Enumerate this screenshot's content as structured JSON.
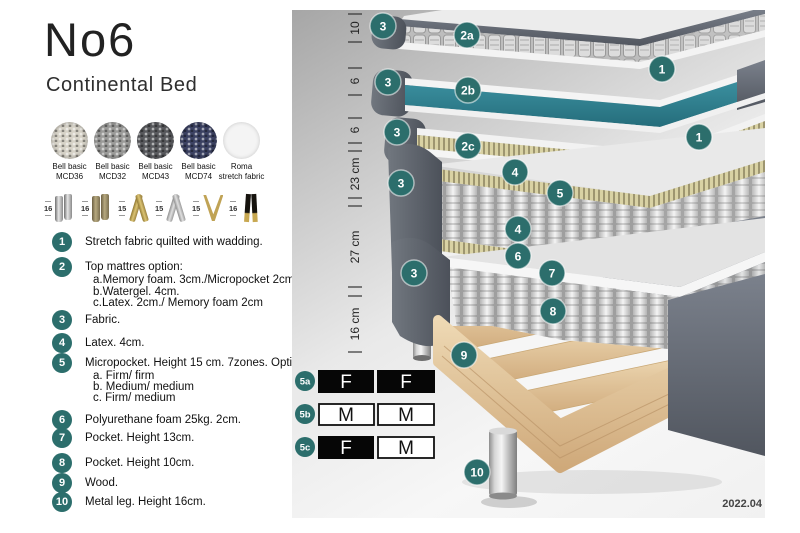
{
  "header": {
    "title": "No6",
    "subtitle": "Continental Bed"
  },
  "fabrics": [
    {
      "line1": "Bell basic",
      "line2": "MCD36",
      "color": "#d6d2c7"
    },
    {
      "line1": "Bell basic",
      "line2": "MCD32",
      "color": "#9b9b99"
    },
    {
      "line1": "Bell basic",
      "line2": "MCD43",
      "color": "#595a5e"
    },
    {
      "line1": "Bell basic",
      "line2": "MCD74",
      "color": "#3c4263"
    },
    {
      "line1": "Roma",
      "line2": "stretch fabric",
      "color": "#f4f4f4"
    }
  ],
  "legs": [
    {
      "height": "16",
      "style": "cylinder-silver"
    },
    {
      "height": "16",
      "style": "cylinder-wood"
    },
    {
      "height": "15",
      "style": "twisted-gold"
    },
    {
      "height": "15",
      "style": "twisted-silver"
    },
    {
      "height": "15",
      "style": "hairpin-gold"
    },
    {
      "height": "16",
      "style": "tapered-black-gold"
    }
  ],
  "legend": [
    {
      "num": "1",
      "text": "Stretch fabric quilted with wadding."
    },
    {
      "num": "2",
      "text": "Top mattres option:",
      "sub": [
        "a.Memory foam. 3cm./Micropocket 2cm",
        "b.Watergel. 4cm.",
        "c.Latex. 2cm./ Memory foam 2cm"
      ]
    },
    {
      "num": "3",
      "text": "Fabric."
    },
    {
      "num": "4",
      "text": "Latex. 4cm."
    },
    {
      "num": "5",
      "text": "Micropocket. Height 15 cm. 7zones. Option:",
      "sub": [
        "a. Firm/ firm",
        "b. Medium/ medium",
        "c. Firm/ medium"
      ]
    },
    {
      "num": "6",
      "text": "Polyurethane foam 25kg. 2cm."
    },
    {
      "num": "7",
      "text": "Pocket. Height 13cm."
    },
    {
      "num": "8",
      "text": "Pocket. Height 10cm."
    },
    {
      "num": "9",
      "text": "Wood."
    },
    {
      "num": "10",
      "text": "Metal leg. Height 16cm."
    }
  ],
  "diagram": {
    "accent_color": "#2c6e6c",
    "top_layer_color": "#2e7f8e",
    "dimensions": [
      "10",
      "6",
      "6",
      "23 cm",
      "27 cm",
      "16 cm"
    ],
    "callouts": [
      "3",
      "2a",
      "1",
      "3",
      "2b",
      "3",
      "2c",
      "1",
      "4",
      "3",
      "5",
      "4",
      "6",
      "3",
      "7",
      "8",
      "9",
      "10"
    ],
    "firmness": [
      {
        "label": "5a",
        "cells": [
          {
            "text": "F",
            "variant": "dark"
          },
          {
            "text": "F",
            "variant": "dark"
          }
        ]
      },
      {
        "label": "5b",
        "cells": [
          {
            "text": "M",
            "variant": "light"
          },
          {
            "text": "M",
            "variant": "light"
          }
        ]
      },
      {
        "label": "5c",
        "cells": [
          {
            "text": "F",
            "variant": "dark"
          },
          {
            "text": "M",
            "variant": "light"
          }
        ]
      }
    ],
    "version_date": "2022.04"
  }
}
